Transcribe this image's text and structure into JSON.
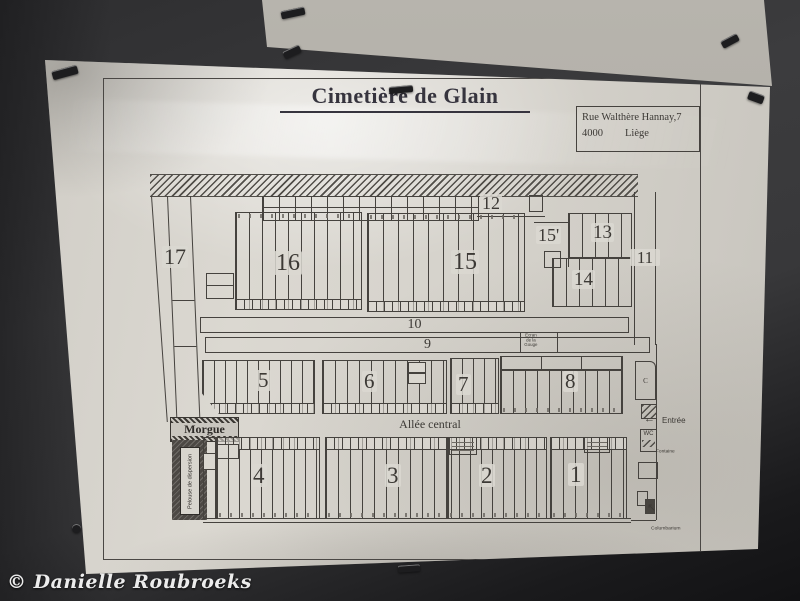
{
  "watermark": "© Danielle Roubroeks",
  "sign": {
    "title": "Cimetière de Glain",
    "address": {
      "line1": "Rue Walthère Hannay,7",
      "postal_code": "4000",
      "city": "Liège"
    }
  },
  "map": {
    "sections": [
      {
        "id": "17",
        "label": "17"
      },
      {
        "id": "16",
        "label": "16"
      },
      {
        "id": "12",
        "label": "12"
      },
      {
        "id": "15",
        "label": "15"
      },
      {
        "id": "15-prime",
        "label": "15'"
      },
      {
        "id": "13",
        "label": "13"
      },
      {
        "id": "14",
        "label": "14"
      },
      {
        "id": "11",
        "label": "11"
      },
      {
        "id": "10",
        "label": "10"
      },
      {
        "id": "9",
        "label": "9"
      },
      {
        "id": "5",
        "label": "5"
      },
      {
        "id": "6",
        "label": "6"
      },
      {
        "id": "7",
        "label": "7"
      },
      {
        "id": "8",
        "label": "8"
      },
      {
        "id": "4",
        "label": "4"
      },
      {
        "id": "3",
        "label": "3"
      },
      {
        "id": "2",
        "label": "2"
      },
      {
        "id": "1",
        "label": "1"
      }
    ],
    "labels": {
      "alley": "Allée central",
      "morgue": "Morgue",
      "dispersion": "Pelouse de dispersion",
      "entrance": "Entrée",
      "wc": "WC",
      "fountain": "Fontaine",
      "columbarium": "Columbarium",
      "c_block": "C",
      "shed_line1": "Ecran",
      "shed_line2": "de la Gouge"
    },
    "icons": {
      "entrance_arrow": "←",
      "columbarium_arrow": "↖"
    }
  }
}
